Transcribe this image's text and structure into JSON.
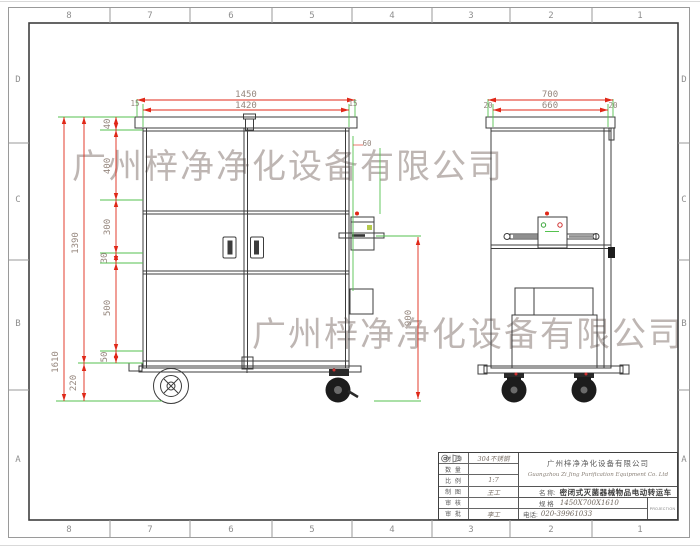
{
  "watermark": {
    "text": "广州梓净净化设备有限公司"
  },
  "frame": {
    "columns": [
      "8",
      "7",
      "6",
      "5",
      "4",
      "3",
      "2",
      "1"
    ],
    "rows": [
      "D",
      "C",
      "B",
      "A"
    ]
  },
  "front_view": {
    "dim_width_total": "1450",
    "dim_width_inner": "1420",
    "dim_flange_left": "15",
    "dim_flange_right": "15",
    "dim_height_total": "1610",
    "dim_height_body": "1390",
    "dim_ground_clearance": "220",
    "dim_chain": [
      "40",
      "400",
      "300",
      "30",
      "500",
      "50"
    ],
    "dim_handle_height": "900",
    "dim_box_offset": "60"
  },
  "side_view": {
    "dim_width_total": "700",
    "dim_width_inner": "660",
    "dim_flange_left": "20",
    "dim_flange_right": "20"
  },
  "title_block": {
    "fields": [
      {
        "label": "材 质",
        "value": "304不锈钢"
      },
      {
        "label": "数 量",
        "value": ""
      },
      {
        "label": "比 例",
        "value": "1:7"
      },
      {
        "label": "制 图",
        "value": "王工"
      },
      {
        "label": "审 核",
        "value": ""
      },
      {
        "label": "审 批",
        "value": "李工"
      }
    ],
    "company_cn": "广州梓净净化设备有限公司",
    "company_en": "Guangzhou Zi Jing Purification Equipment Co. Ltd",
    "name_label": "名 称:",
    "name_value": "密闭式灭菌器械物品电动转运车",
    "spec_label": "规 格",
    "spec_value": "1450X700X1610",
    "phone_label": "电话:",
    "phone_value": "020-39961033",
    "projection_label": "PROJECTION"
  },
  "colors": {
    "dimension_line": "#e02818",
    "extension_line": "#55c24f",
    "drawing_line": "#3c3c3c",
    "dimension_text": "#95867d",
    "watermark": "#96867e"
  }
}
